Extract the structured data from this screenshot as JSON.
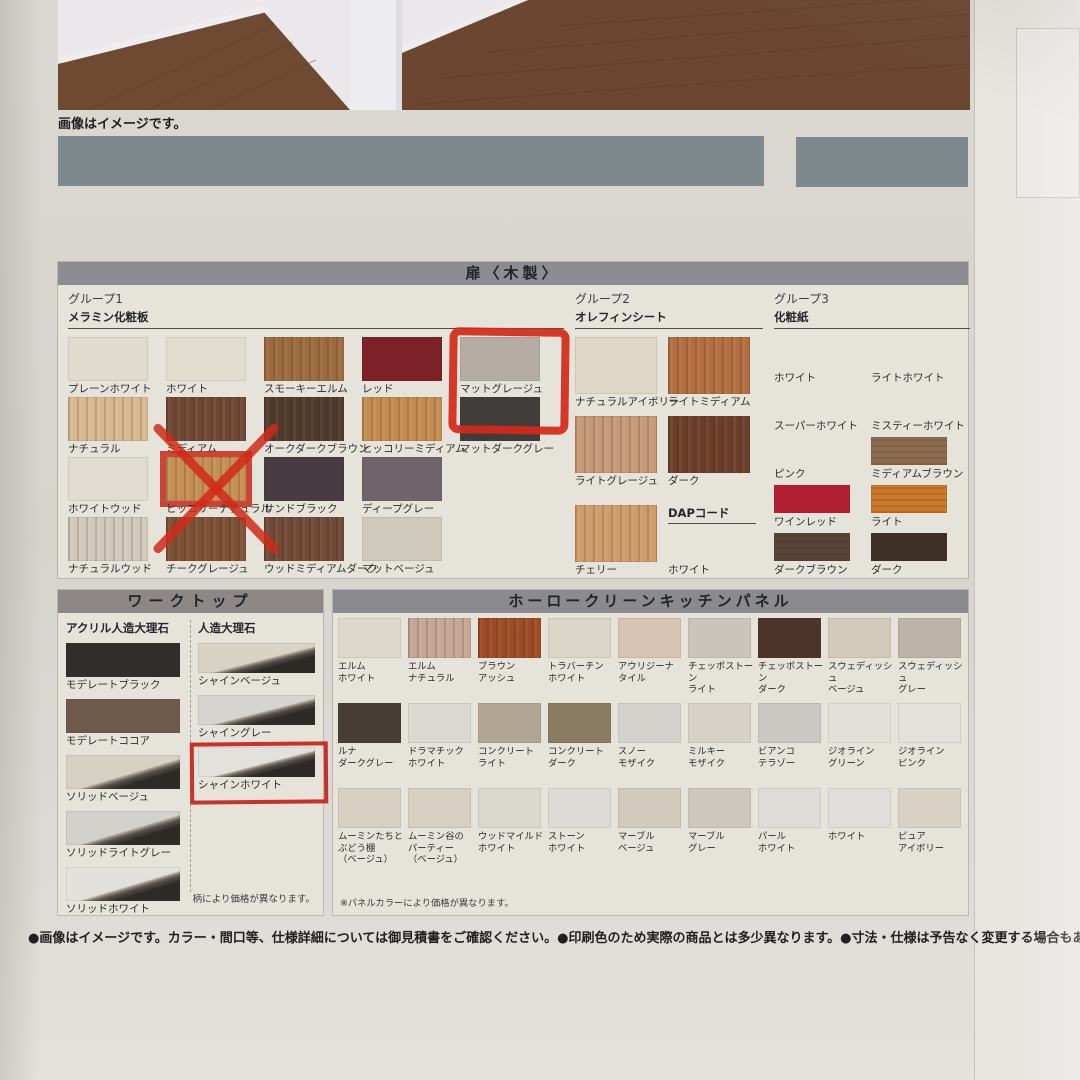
{
  "photo": {
    "caption": "画像はイメージです。"
  },
  "door": {
    "title": "扉〈木製〉",
    "group1": {
      "name": "グループ1",
      "material": "メラミン化粧板",
      "rows": [
        [
          {
            "label": "プレーンホワイト",
            "color": "#dfdbce"
          },
          {
            "label": "ホワイト",
            "color": "#e0ddcf"
          },
          {
            "label": "スモーキーエルム",
            "color": "#9c6b3e",
            "grain": "v"
          },
          {
            "label": "レッド",
            "color": "#7c2127"
          },
          {
            "label": "マットグレージュ",
            "color": "#b5aca6",
            "annotation": "circle"
          }
        ],
        [
          {
            "label": "ナチュラル",
            "color": "#d6b990",
            "grain": "v"
          },
          {
            "label": "ミディアム",
            "color": "#6e4834",
            "grain": "v"
          },
          {
            "label": "オークダークブラウン",
            "color": "#4e3a2c",
            "grain": "v"
          },
          {
            "label": "ヒッコリーミディアム",
            "color": "#c28c50",
            "grain": "v"
          },
          {
            "label": "マットダークグレー",
            "color": "#403c3a"
          }
        ],
        [
          {
            "label": "ホワイトウッド",
            "color": "#e0dcd1"
          },
          {
            "label": "ヒッコリーナチュラル",
            "color": "#c48e54",
            "grain": "v",
            "annotation": "cross"
          },
          {
            "label": "サンドブラック",
            "color": "#483c42"
          },
          {
            "label": "ディープグレー",
            "color": "#70646b"
          }
        ],
        [
          {
            "label": "ナチュラルウッド",
            "color": "#d1cabc",
            "grain": "v"
          },
          {
            "label": "チークグレージュ",
            "color": "#7d4f35",
            "grain": "v"
          },
          {
            "label": "ウッドミディアムダーク",
            "color": "#714936",
            "grain": "v"
          },
          {
            "label": "マットベージュ",
            "color": "#cec9ba"
          }
        ]
      ]
    },
    "group2": {
      "name": "グループ2",
      "material": "オレフィンシート",
      "rows": [
        [
          {
            "label": "ナチュラルアイボリー",
            "color": "#ded7c7"
          },
          {
            "label": "ライトミディアム",
            "color": "#b26e40",
            "grain": "v"
          }
        ],
        [
          {
            "label": "ライトグレージュ",
            "color": "#c69a78",
            "grain": "v"
          },
          {
            "label": "ダーク",
            "color": "#6c3e2a",
            "grain": "v"
          }
        ],
        [
          {
            "label": "チェリー",
            "color": "#d09c6c",
            "grain": "v"
          },
          {
            "label": "ホワイト",
            "color": null,
            "subheader": "DAPコード"
          }
        ]
      ]
    },
    "group3": {
      "name": "グループ3",
      "material": "化粧紙",
      "rows": [
        [
          {
            "label": "ホワイト",
            "color": null
          },
          {
            "label": "ライトホワイト",
            "color": null
          }
        ],
        [
          {
            "label": "スーパーホワイト",
            "color": null
          },
          {
            "label": "ミスティーホワイト",
            "color": null
          }
        ],
        [
          {
            "label": "ピンク",
            "color": null
          },
          {
            "label": "ミディアムブラウン",
            "color": "#8d6d51",
            "grain": "h"
          }
        ],
        [
          {
            "label": "ワインレッド",
            "color": "#b22133"
          },
          {
            "label": "ライト",
            "color": "#ca7b2b",
            "grain": "h"
          }
        ],
        [
          {
            "label": "ダークブラウン",
            "color": "#584439",
            "grain": "h"
          },
          {
            "label": "ダーク",
            "color": "#3f3129",
            "grain": "h"
          }
        ]
      ]
    }
  },
  "worktop": {
    "title": "ワークトップ",
    "acrylic": {
      "name": "アクリル人造大理石",
      "items": [
        {
          "label": "モデレートブラック",
          "color": "#312d2a"
        },
        {
          "label": "モデレートココア",
          "color": "#6f594b"
        },
        {
          "label": "ソリッドベージュ",
          "color": "#d7d1c3",
          "style": "edge"
        },
        {
          "label": "ソリッドライトグレー",
          "color": "#d3d1cb",
          "style": "edge"
        },
        {
          "label": "ソリッドホワイト",
          "color": "#e2e0da",
          "style": "edge"
        }
      ]
    },
    "marble": {
      "name": "人造大理石",
      "items": [
        {
          "label": "シャインベージュ",
          "color": "#d9d3c5",
          "style": "edge"
        },
        {
          "label": "シャイングレー",
          "color": "#d6d4cf",
          "style": "edge"
        },
        {
          "label": "シャインホワイト",
          "color": "#e3e1dc",
          "style": "edge",
          "annotation": "frame"
        }
      ]
    },
    "note": "柄により価格が異なります。"
  },
  "panel": {
    "title": "ホーロークリーンキッチンパネル",
    "rows": [
      [
        {
          "label": "エルム\nホワイト",
          "color": "#dcd8ca"
        },
        {
          "label": "エルム\nナチュラル",
          "color": "#c3a695",
          "grain": "v"
        },
        {
          "label": "ブラウン\nアッシュ",
          "color": "#9d4a27",
          "grain": "v"
        },
        {
          "label": "トラバーチン\nホワイト",
          "color": "#dad6c8"
        },
        {
          "label": "アウリジーナ\nタイル",
          "color": "#d7c4b2"
        },
        {
          "label": "チェッポストーン\nライト",
          "color": "#cac4ba"
        },
        {
          "label": "チェッポストーン\nダーク",
          "color": "#4c342b"
        },
        {
          "label": "スウェディッシュ\nベージュ",
          "color": "#d3cabc"
        },
        {
          "label": "スウェディッシュ\nグレー",
          "color": "#bdb4a8"
        }
      ],
      [
        {
          "label": "ルナ\nダークグレー",
          "color": "#483d37"
        },
        {
          "label": "ドラマチック\nホワイト",
          "color": "#dbd9d1"
        },
        {
          "label": "コンクリート\nライト",
          "color": "#b1a593"
        },
        {
          "label": "コンクリート\nダーク",
          "color": "#8a7b63"
        },
        {
          "label": "スノー\nモザイク",
          "color": "#d4d2cc"
        },
        {
          "label": "ミルキー\nモザイク",
          "color": "#d6d2c8"
        },
        {
          "label": "ビアンコ\nテラゾー",
          "color": "#cbc7c3"
        },
        {
          "label": "ジオライン\nグリーン",
          "color": "#e2e0d9"
        },
        {
          "label": "ジオライン\nピンク",
          "color": "#e4e0dc"
        }
      ],
      [
        {
          "label": "ムーミンたちと\nぶどう棚\n（ベージュ）",
          "color": "#d6cfc2"
        },
        {
          "label": "ムーミン谷の\nパーティー\n（ベージュ）",
          "color": "#d6cfc2"
        },
        {
          "label": "ウッドマイルド\nホワイト",
          "color": "#dbd8d0"
        },
        {
          "label": "ストーン\nホワイト",
          "color": "#dcdad4"
        },
        {
          "label": "マーブル\nベージュ",
          "color": "#d2cabc"
        },
        {
          "label": "マーブル\nグレー",
          "color": "#ccc8c0"
        },
        {
          "label": "パール\nホワイト",
          "color": "#dedcd6"
        },
        {
          "label": "ホワイト",
          "color": "#e0dedb"
        },
        {
          "label": "ピュア\nアイボリー",
          "color": "#d8d2c6"
        }
      ]
    ],
    "note": "※パネルカラーにより価格が異なります。"
  },
  "annotations": {
    "circled": "マットグレージュ",
    "crossed_out": "ヒッコリーナチュラル",
    "framed": "シャインホワイト",
    "marker_color": "#d2301e"
  },
  "footer": "●画像はイメージです。カラー・間口等、仕様詳細については御見積書をご確認ください。●印刷色のため実際の商品とは多少異なります。●寸法・仕様は予告なく変更する場合もありますの"
}
